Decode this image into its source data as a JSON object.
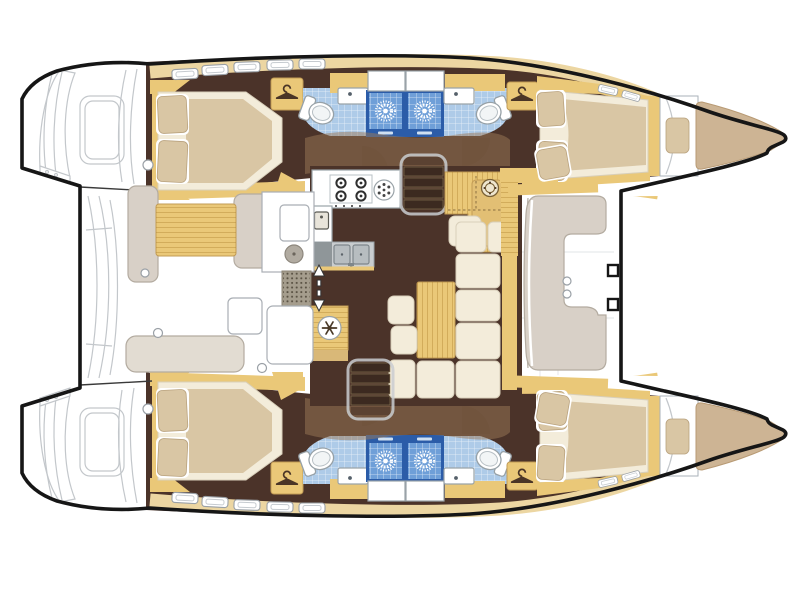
{
  "page": {
    "title": "Catamaran interior floor plan (top view)"
  },
  "colors": {
    "hullLine": "#161616",
    "sketch": "#c3c7cb",
    "floorDark": "#4b3329",
    "shadowTan": "#9c7a57",
    "shadowArc": "#6e4f38",
    "wood": "#eac878",
    "woodDark": "#c29b55",
    "band": "#ecd6a2",
    "cream": "#f3ecda",
    "creamStroke": "#d8cfba",
    "beige": "#d9c6a4",
    "beigeStroke": "#b9a27e",
    "taupe": "#d8d0c7",
    "taupeStroke": "#b3aba0",
    "bench": "#e2dcd2",
    "blueTile": "#6f9fd8",
    "blueFrame": "#2b5ca8",
    "blueFloor": "#aecbe8",
    "fixStroke": "#9aa3a8",
    "grayCounter": "#c9cdcf",
    "graySink": "#b7bdc0",
    "grayDark": "#8f9699",
    "grate": "#a59d8d",
    "grateDot": "#5a5244",
    "iconDark": "#4a3526",
    "hatchStroke": "#9aa0a6",
    "bowPad": "#cdb494",
    "bowPadStroke": "#b89a74",
    "stairTread": "#3c2a20",
    "stairRail": "#c9cdd0"
  },
  "areas": {
    "salon": "salon with galley, nav station and dinette",
    "aft_cockpit": "aft cockpit with table, benches and wet bar",
    "fwd_cockpit": "forward cockpit with C-shaped seat",
    "cabins": [
      "port aft cabin",
      "port forward cabin",
      "starboard aft cabin",
      "starboard forward cabin"
    ],
    "heads": [
      "port aft head",
      "port forward head",
      "starboard aft head",
      "starboard forward head"
    ],
    "shower_count": 4,
    "hanger_locker_count": 4
  },
  "icons": {
    "shower_rose": "sunburst",
    "hanger": "clothes-hanger",
    "fridge": "snowflake",
    "nav_instrument": "compass",
    "companionway": "double-arrow",
    "stove_burners": 4,
    "galley_sinks": 2
  }
}
